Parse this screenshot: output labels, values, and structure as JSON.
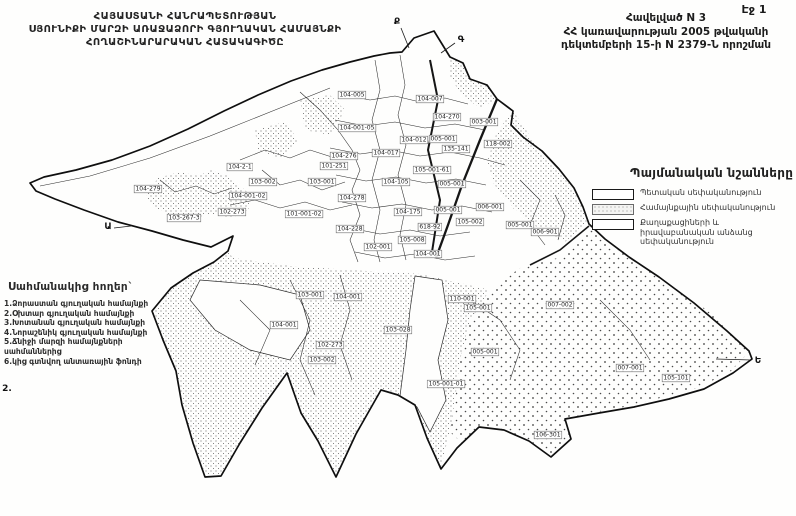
{
  "page": {
    "number_label": "Էջ 1"
  },
  "title_block": {
    "line1": "ՀԱՅԱՍՏԱՆԻ ՀԱՆՐԱՊԵՏՈՒԹՅԱՆ",
    "line2": "ՍՅՈՒՆԻՔԻ ՄԱՐԶԻ ԱՌԱՋԱՁՈՐԻ ԳՅՈՒՂԱԿԱՆ ՀԱՄԱՅՆՔԻ",
    "line3": "ՀՈՂԱՇԻՆԱՐԱՐԱԿԱՆ  ՀԱՏԱԿԱԳԻԾԸ"
  },
  "annex_block": {
    "line1": "Հավելված N 3",
    "line2": "ՀՀ կառավարության 2005 թվականի",
    "line3": "դեկտեմբերի 15-ի N 2379-Ն որոշման"
  },
  "legend": {
    "title": "Պայմանական նշանները",
    "items": [
      {
        "label": "Պետական սեփականություն",
        "pattern": "empty"
      },
      {
        "label": "Համայնքային սեփականություն",
        "pattern": "dots"
      },
      {
        "label": "Քաղաքացիների և իրավաբանական անձանց սեփականություն",
        "pattern": "empty"
      }
    ]
  },
  "adjacent_lands": {
    "title": "Սահմանակից հողեր`",
    "items": [
      "1.Ձորաստան գյուղական համայնքի",
      "2.Օխտար գյուղական համայնքի",
      "3.Խոտանան գյուղական համայնքի",
      "4.Նորաշենիկ գյուղական համայնքի",
      "5.Ճնիջի մարզի համայնքների սահմաններից",
      "6.կից գտնվող անտառային ֆոնդի"
    ]
  },
  "map": {
    "boundary_marks": [
      {
        "label": "Ք",
        "x": 397,
        "y": 22
      },
      {
        "label": "Գ",
        "x": 461,
        "y": 40
      },
      {
        "label": "Ա",
        "x": 108,
        "y": 227
      },
      {
        "label": "Ե",
        "x": 758,
        "y": 361
      },
      {
        "label": "2.",
        "x": 7,
        "y": 389
      }
    ],
    "parcel_labels": [
      {
        "text": "104-005",
        "x": 352,
        "y": 95
      },
      {
        "text": "104-007",
        "x": 430,
        "y": 99
      },
      {
        "text": "104-270",
        "x": 447,
        "y": 117
      },
      {
        "text": "003-001",
        "x": 484,
        "y": 122
      },
      {
        "text": "104-001-05",
        "x": 357,
        "y": 128
      },
      {
        "text": "104-012",
        "x": 414,
        "y": 140
      },
      {
        "text": "005-001",
        "x": 443,
        "y": 139
      },
      {
        "text": "118-002",
        "x": 498,
        "y": 144
      },
      {
        "text": "135-141",
        "x": 456,
        "y": 149
      },
      {
        "text": "104-276",
        "x": 344,
        "y": 156
      },
      {
        "text": "104-017",
        "x": 386,
        "y": 153
      },
      {
        "text": "101-251",
        "x": 334,
        "y": 166
      },
      {
        "text": "105-001-61",
        "x": 432,
        "y": 170
      },
      {
        "text": "104-105",
        "x": 396,
        "y": 182
      },
      {
        "text": "005-001",
        "x": 452,
        "y": 184
      },
      {
        "text": "104-278",
        "x": 352,
        "y": 198
      },
      {
        "text": "104-175",
        "x": 408,
        "y": 212
      },
      {
        "text": "005-001",
        "x": 448,
        "y": 210
      },
      {
        "text": "618-92",
        "x": 430,
        "y": 227
      },
      {
        "text": "104-228",
        "x": 350,
        "y": 229
      },
      {
        "text": "105-008",
        "x": 412,
        "y": 240
      },
      {
        "text": "102-001",
        "x": 378,
        "y": 247
      },
      {
        "text": "104-001",
        "x": 428,
        "y": 254
      },
      {
        "text": "104-2-1",
        "x": 240,
        "y": 167
      },
      {
        "text": "103-002",
        "x": 263,
        "y": 182
      },
      {
        "text": "103-001",
        "x": 322,
        "y": 182
      },
      {
        "text": "104-001-02",
        "x": 248,
        "y": 196
      },
      {
        "text": "102-273",
        "x": 232,
        "y": 212
      },
      {
        "text": "103-267-3",
        "x": 184,
        "y": 218
      },
      {
        "text": "101-001-02",
        "x": 304,
        "y": 214
      },
      {
        "text": "104-279",
        "x": 148,
        "y": 189
      },
      {
        "text": "006-001",
        "x": 490,
        "y": 207
      },
      {
        "text": "005-001",
        "x": 520,
        "y": 225
      },
      {
        "text": "006-901",
        "x": 545,
        "y": 232
      },
      {
        "text": "105-002",
        "x": 470,
        "y": 222
      },
      {
        "text": "103-001",
        "x": 310,
        "y": 295
      },
      {
        "text": "104-001",
        "x": 348,
        "y": 297
      },
      {
        "text": "110-001",
        "x": 462,
        "y": 299
      },
      {
        "text": "105-001",
        "x": 478,
        "y": 308
      },
      {
        "text": "007-002",
        "x": 560,
        "y": 305
      },
      {
        "text": "104-001",
        "x": 284,
        "y": 325
      },
      {
        "text": "103-028",
        "x": 398,
        "y": 330
      },
      {
        "text": "102-273",
        "x": 330,
        "y": 345
      },
      {
        "text": "103-002",
        "x": 322,
        "y": 360
      },
      {
        "text": "005-001",
        "x": 485,
        "y": 352
      },
      {
        "text": "105-001-01",
        "x": 446,
        "y": 384
      },
      {
        "text": "007-001",
        "x": 630,
        "y": 368
      },
      {
        "text": "105-101",
        "x": 676,
        "y": 378
      },
      {
        "text": "106-301",
        "x": 548,
        "y": 435
      }
    ]
  },
  "colors": {
    "ink": "#1b1b1b",
    "paper": "#fefefd"
  }
}
